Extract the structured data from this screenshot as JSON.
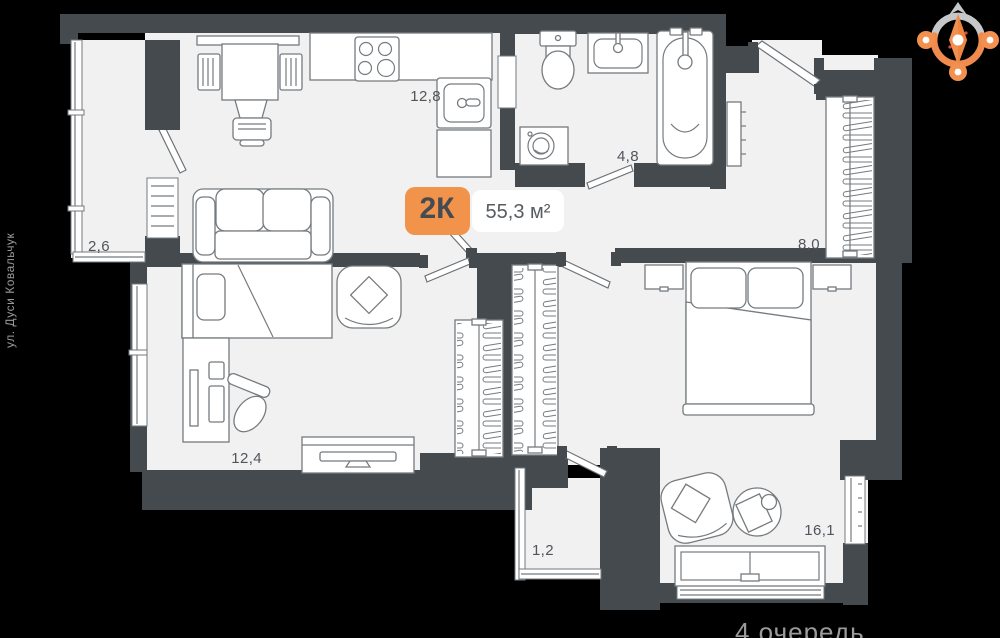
{
  "plan": {
    "type_badge": "2К",
    "total_area": "55,3 м²",
    "street_label": "ул. Дуси Ковальчук",
    "phase_label": "4 очередь",
    "rooms": {
      "kitchen_living": "12,8",
      "balcony_left": "2,6",
      "bathroom": "4,8",
      "hallway": "8,0",
      "bedroom_small": "12,4",
      "bedroom_master": "16,1",
      "balcony_bottom": "1,2"
    },
    "colors": {
      "accent_orange": "#F2934C",
      "wall_dark": "#454A4E",
      "floor_light": "#F1F1F2",
      "background": "#000000",
      "label_text": "#4F555A",
      "muted_text": "#9B9B9B",
      "furniture_stroke": "#757B7F",
      "compass_gray": "#C6C7C8"
    },
    "icons": {
      "compass": "compass-rose"
    }
  }
}
